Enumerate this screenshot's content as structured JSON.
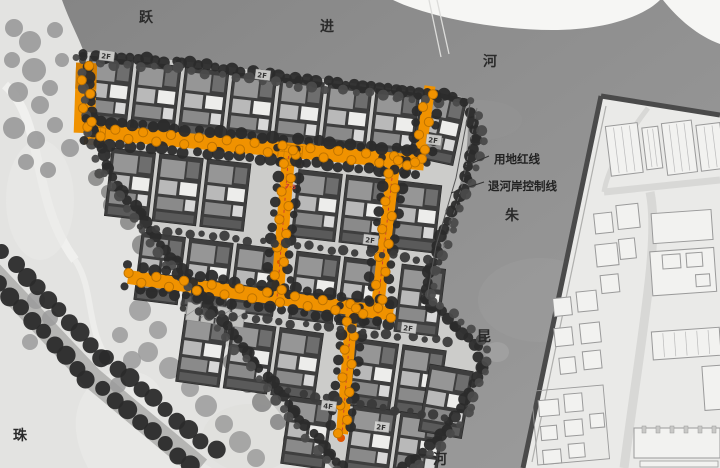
{
  "map": {
    "kind": "residential master plan with rivers, park and existing town"
  },
  "labels": {
    "river_top": [
      "跃",
      "进",
      "河"
    ],
    "river_right": [
      "朱",
      "昆",
      "河"
    ],
    "river_bottom_left": "珠",
    "red_line": "用地红线",
    "setback_line": "退河岸控制线",
    "path_node": "7-5",
    "floors": [
      {
        "text": "2F"
      },
      {
        "text": "2F"
      },
      {
        "text": "2F"
      },
      {
        "text": "2F"
      },
      {
        "text": "2F"
      },
      {
        "text": "2F"
      },
      {
        "text": "4F"
      }
    ]
  },
  "colors": {
    "orange": "#F09200",
    "orange_dark": "#D47E00",
    "orange_tree_stroke": "#BF7300",
    "marker_red": "#E05400",
    "red_dash": "#CC3A33",
    "river_a": "#868686",
    "river_b": "#9C9C9C",
    "site_ground": "#CCCCCA",
    "building_dark": "#3E3E3E",
    "tree_dark": "#2B2B2B",
    "tree_mid": "#4A4A4A",
    "park_tree": "#9B9B9B",
    "park_tree_dk": "#8A8A8A",
    "park_ground": "#E3E3E1",
    "cad_ground": "#EAEAE8",
    "cad_fill": "#F2F2F0",
    "cad_stroke": "#9A9A9A",
    "far_shore": "#F6F6F4",
    "bank_dark": "#4A4A4A"
  }
}
